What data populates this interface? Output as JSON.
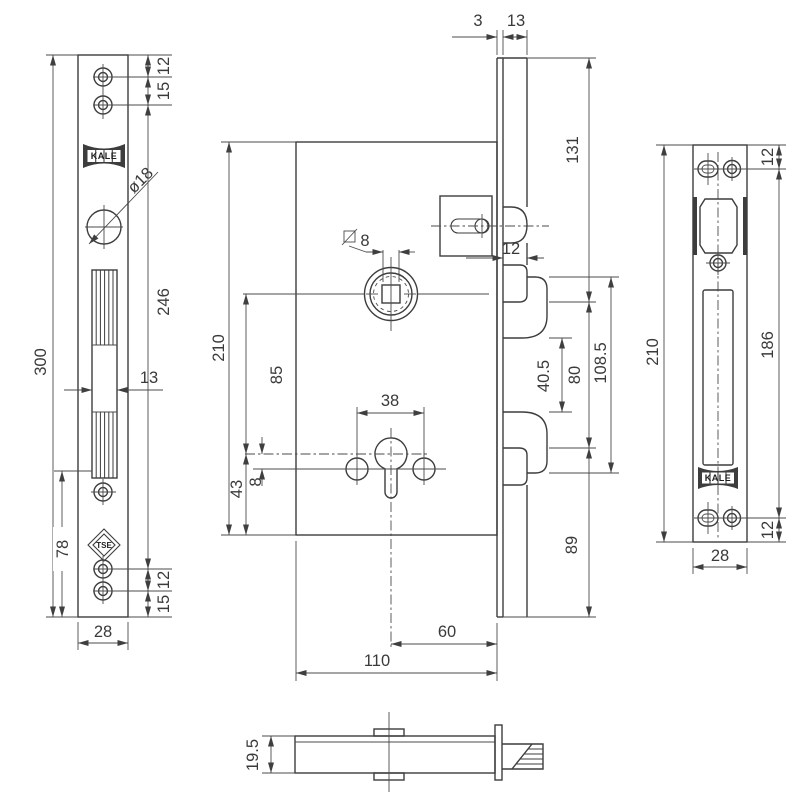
{
  "labels": {
    "left": {
      "overall": "300",
      "top_offset": "12",
      "top_spacing": "15",
      "hole_span": "246",
      "slot_width": "13",
      "lower_section": "78",
      "bottom_spacing": "12",
      "bottom_edge": "15",
      "width": "28",
      "hole_dia": "ø18"
    },
    "center": {
      "height": "210",
      "spindle_to_cyl": "85",
      "cyl_to_edge": "43",
      "hole_offset": "8",
      "square_size": "8",
      "screw_span": "38",
      "backset": "60",
      "depth": "110"
    },
    "faceplate_top": {
      "thickness": "3",
      "offset": "13"
    },
    "side": {
      "top_span": "131",
      "protrusion": "12",
      "bolt_gap": "40.5",
      "bolt_span": "80",
      "outer_span": "108.5",
      "bottom_span": "89"
    },
    "right": {
      "top_offset": "12",
      "hole_span": "186",
      "bottom_offset": "12",
      "height": "210",
      "width": "28"
    },
    "bottom": {
      "thickness": "19.5"
    },
    "logos": {
      "brand": "KALE",
      "cert": "TSE"
    }
  }
}
